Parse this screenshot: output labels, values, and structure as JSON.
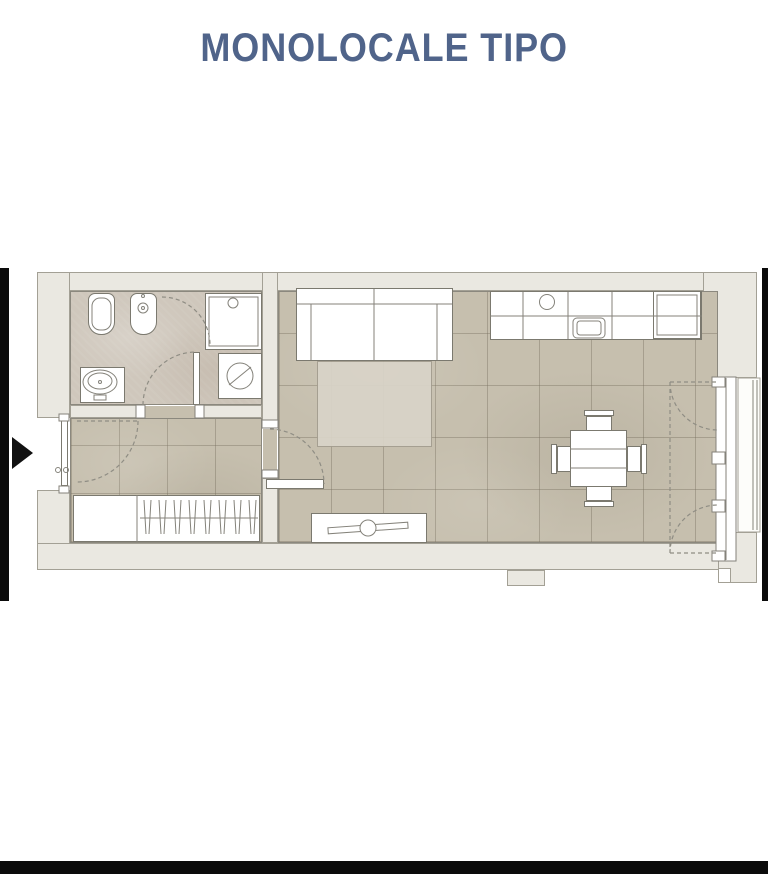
{
  "title": {
    "text": "MONOLOCALE TIPO"
  },
  "colors": {
    "title": "#50648a",
    "black-frame": "#0b0b0b",
    "wall-fill": "#eae8e1",
    "wall-line": "#a3a095",
    "floor-tile": "#c6bfae",
    "floor-bath": "#cfc7bc",
    "fixture-line": "#7b796f",
    "dash-line": "#8f8d84",
    "rug": "#d9d4c8"
  },
  "plan": {
    "label": "studio apartment floor plan",
    "rooms": [
      {
        "name": "bathroom",
        "fixtures": [
          "toilet",
          "bidet",
          "shower-box",
          "washing-machine",
          "washbasin-vanity"
        ]
      },
      {
        "name": "entry-hall",
        "fixtures": [
          "entry-door",
          "wardrobe-with-hangers"
        ]
      },
      {
        "name": "living-area",
        "fixtures": [
          "sofa-bed",
          "rug",
          "kitchen-counter",
          "kitchen-sink",
          "tall-fridge-unit",
          "dining-table",
          "four-chairs",
          "tv-sideboard"
        ]
      },
      {
        "name": "balcony",
        "fixtures": [
          "french-window",
          "railing"
        ]
      }
    ],
    "entrance_marker": "right-pointing-arrow"
  }
}
